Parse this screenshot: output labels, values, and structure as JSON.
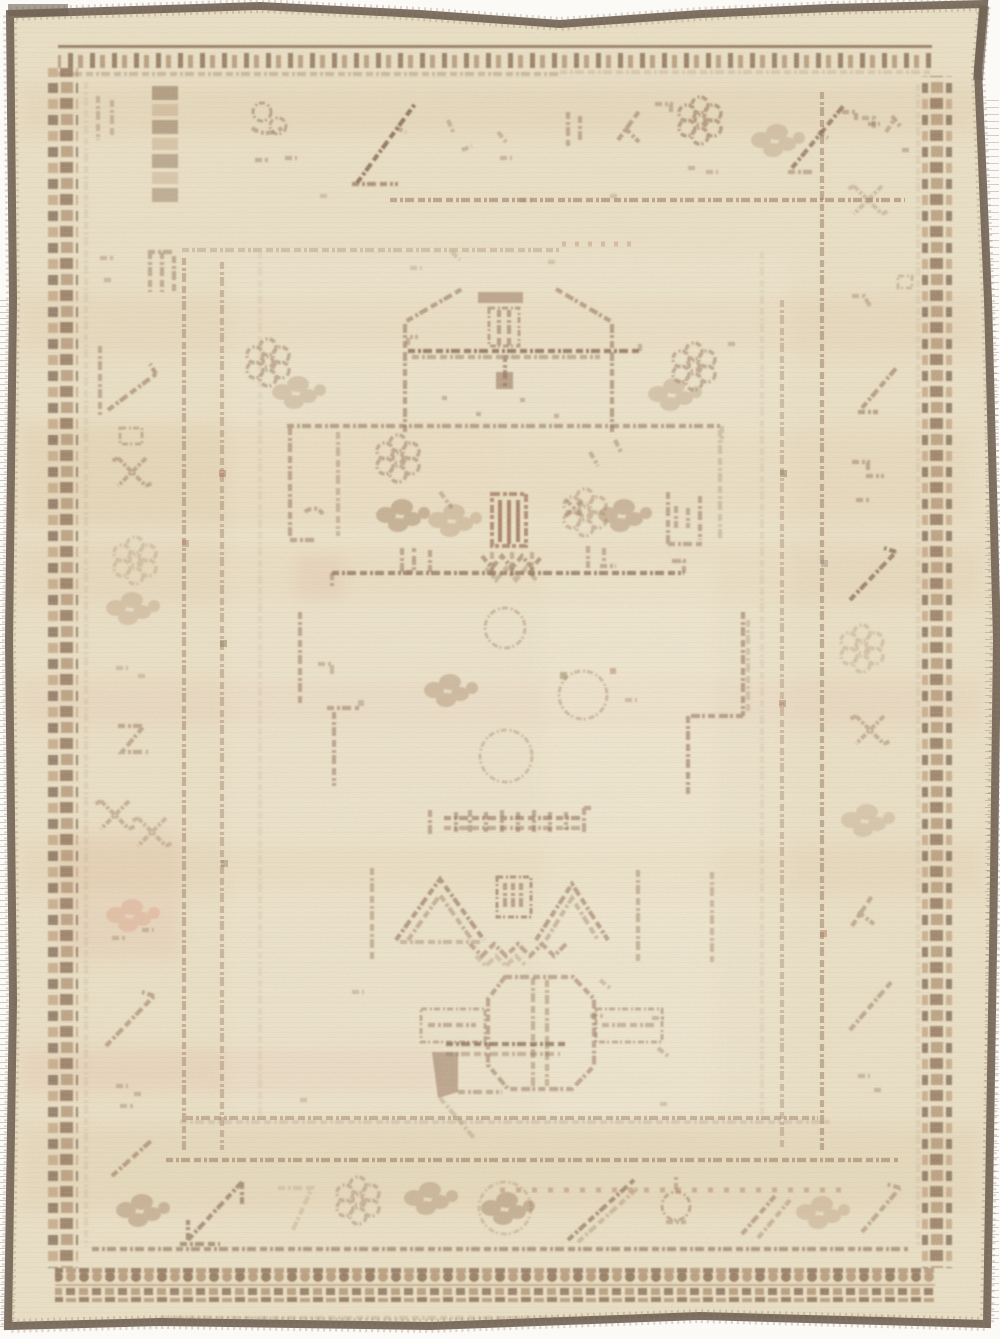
{
  "scene": {
    "domain": "natural-image",
    "subject": "Antique hand-knotted cream wool rug photographed flat",
    "description": "Heavily faded antique Oushak-style cream wool rug with pale brown tribal motifs: a gabled prayer-arch with a cross-and-ladder finial, a rectangular central panel holding rosette clusters and a red-brown comb motif, twin chevrons with a gate motif, and an octagon gul with cross arms; framed by dotted guard stripes, a wide faded main border of slashes, scrolls and blossoms, checkered guard bands and a dark grey-brown selvedge edge.",
    "orientation": "portrait",
    "condition": "distressed, sun-faded pile with abrash streaks"
  },
  "palette": {
    "canvas": "#fbfaf6",
    "base": "#eae0c6",
    "field_light": "#f3ecd6",
    "ink": "#86634a",
    "ink2": "#9d7e60",
    "ink_faded": "#b59878",
    "ink_dark": "#6d4c36",
    "comb_red": "#8b5a40",
    "selvedge": "#6f6152",
    "selvedge_light": "#8b7b68",
    "guard_dark": "#7d5f46",
    "guard_dark2": "#6f5845",
    "guard_tan": "#bb9b78",
    "guard_mid": "#a98a68",
    "abrash_tan": "#d6bd97",
    "abrash_warm": "#dcc097",
    "abrash_pink": "#dca890",
    "pink_spot": "#dfa291",
    "dot_rust": "#9c5f43",
    "dot_olive": "#7a6b45",
    "dot_grey": "#7b6f66",
    "dot_red_row": "#a5674b",
    "pile_row": "#c5ad89"
  },
  "rug": {
    "bands_outer_to_inner": [
      "dark selvedge edge",
      "plain cream outer margin",
      "checkered guard band",
      "wide main border with faded motifs",
      "dotted guard stripes",
      "open cream field"
    ],
    "field_motifs": [
      "gabled prayer arch with cross-and-ladder finial",
      "flanking rosette clusters",
      "rectangular central panel with rosette clusters and comb motif",
      "corner brackets",
      "step meanders",
      "dotted colonnettes",
      "inscription-like dash row",
      "twin chevrons with gate motif",
      "octagon gul with cross arms"
    ],
    "border_motifs": [
      "diagonal slashes",
      "hooked X motifs",
      "S-scrolls",
      "rosette rings",
      "blossom clusters",
      "bird-like diagonal forms",
      "ladder blocks"
    ]
  }
}
